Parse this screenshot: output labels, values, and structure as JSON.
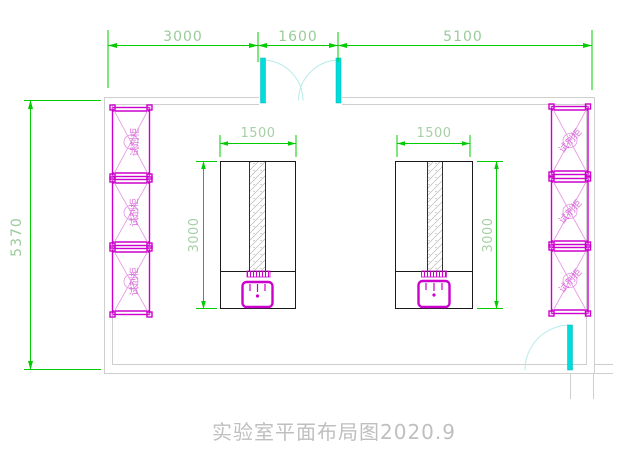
{
  "title": "实验室平面布局图2020.9",
  "dimensions": {
    "top_segment_left": "3000",
    "top_segment_door": "1600",
    "top_segment_right": "5100",
    "left_wall_height": "5370",
    "bench_width": "1500",
    "bench_depth": "3000"
  },
  "cabinets": {
    "label": "试剂柜",
    "left_count": 3,
    "right_count": 3
  },
  "fixtures": {
    "left_bench": "lab-bench-with-reagent-shelf-and-sink",
    "right_bench": "lab-bench-with-reagent-shelf-and-sink",
    "top_door": "double-swing-door",
    "right_door": "single-swing-door"
  },
  "colors": {
    "dimension_line": "#00cc00",
    "dimension_text": "#9acb9a",
    "cabinet": "#cc00cc",
    "cabinet_light": "#e693e6",
    "door": "#00dcdc",
    "door_arc": "#b7eaea",
    "wall": "#cfcfcf",
    "bench_outline": "#1a1a1a",
    "title_text": "#bfbfbf"
  }
}
